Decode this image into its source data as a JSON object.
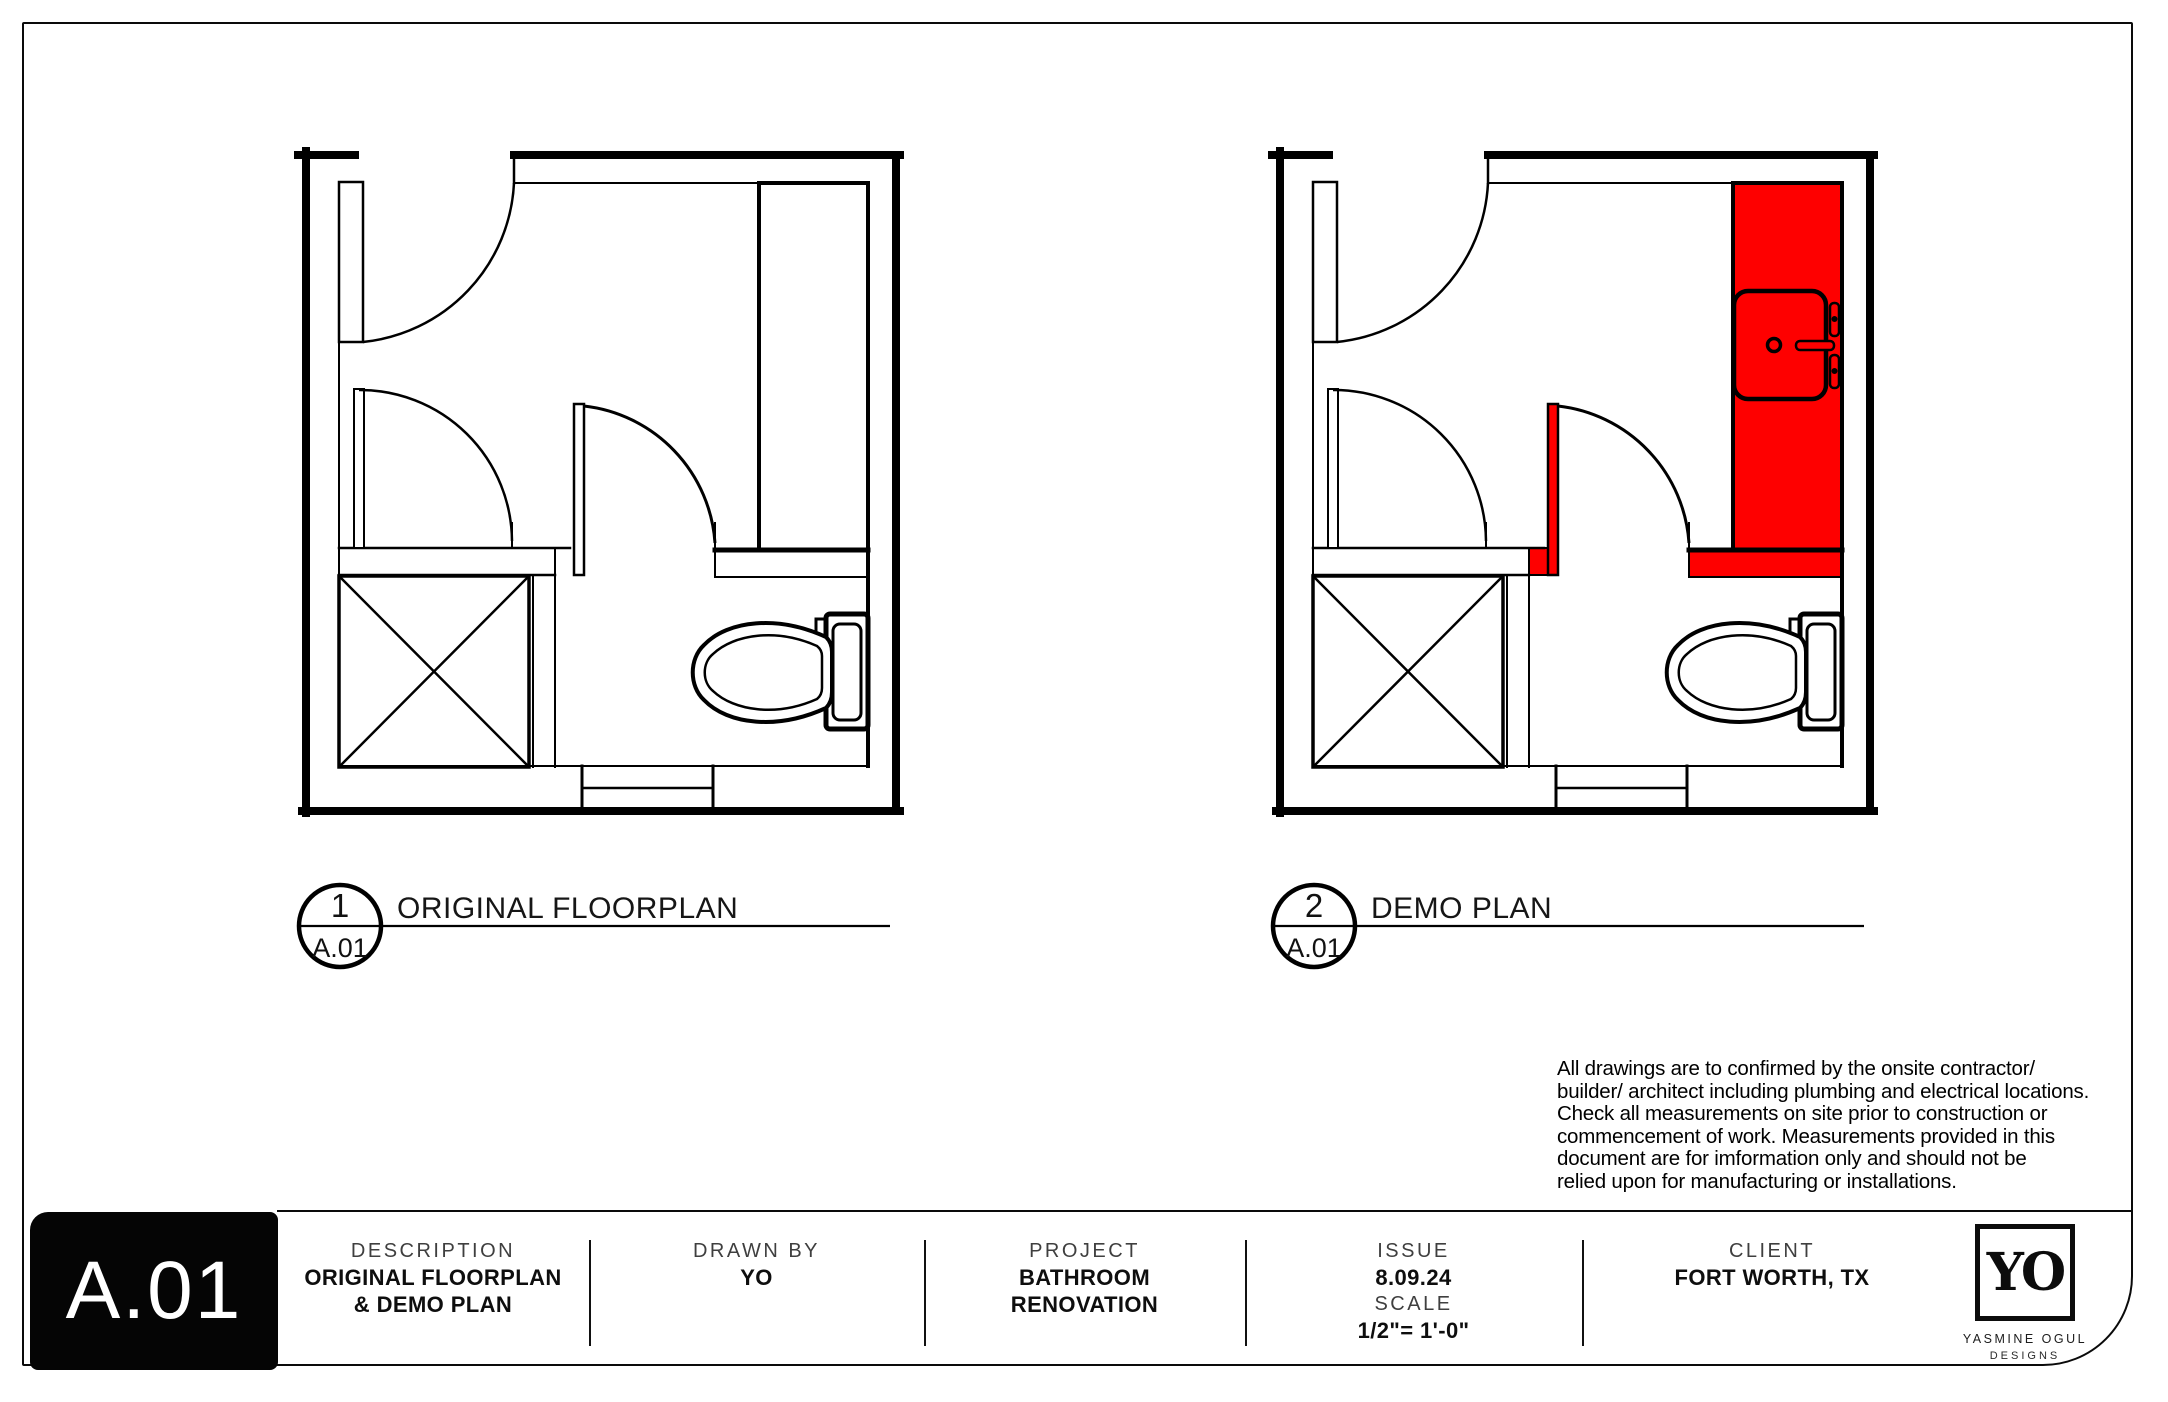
{
  "colors": {
    "demo_red": "#fe0000",
    "line": "#000000"
  },
  "plans": [
    {
      "number": "1",
      "sheet_ref": "A.01",
      "title": "ORIGINAL FLOORPLAN"
    },
    {
      "number": "2",
      "sheet_ref": "A.01",
      "title": "DEMO PLAN"
    }
  ],
  "disclaimer": {
    "lines": [
      "All drawings are to confirmed by the onsite contractor/",
      "builder/ architect including plumbing and electrical locations.",
      "Check all measurements on site prior to construction or",
      "commencement of work. Measurements provided in this",
      "document are for imformation only and should not be",
      "relied upon for manufacturing or installations."
    ]
  },
  "title_block": {
    "sheet_number": "A.01",
    "columns": [
      {
        "label": "DESCRIPTION",
        "value_lines": [
          "ORIGINAL FLOORPLAN",
          "& DEMO PLAN"
        ]
      },
      {
        "label": "DRAWN BY",
        "value_lines": [
          "YO"
        ]
      },
      {
        "label": "PROJECT",
        "value_lines": [
          "BATHROOM",
          "RENOVATION"
        ]
      },
      {
        "label": "ISSUE",
        "value_lines": [
          "8.09.24"
        ],
        "label2": "SCALE",
        "value2_lines": [
          "1/2\"= 1'-0\""
        ]
      },
      {
        "label": "CLIENT",
        "value_lines": [
          "FORT WORTH, TX"
        ]
      }
    ],
    "logo": {
      "monogram": "YO",
      "name": "YASMINE OGUL",
      "sub": "DESIGNS"
    }
  }
}
